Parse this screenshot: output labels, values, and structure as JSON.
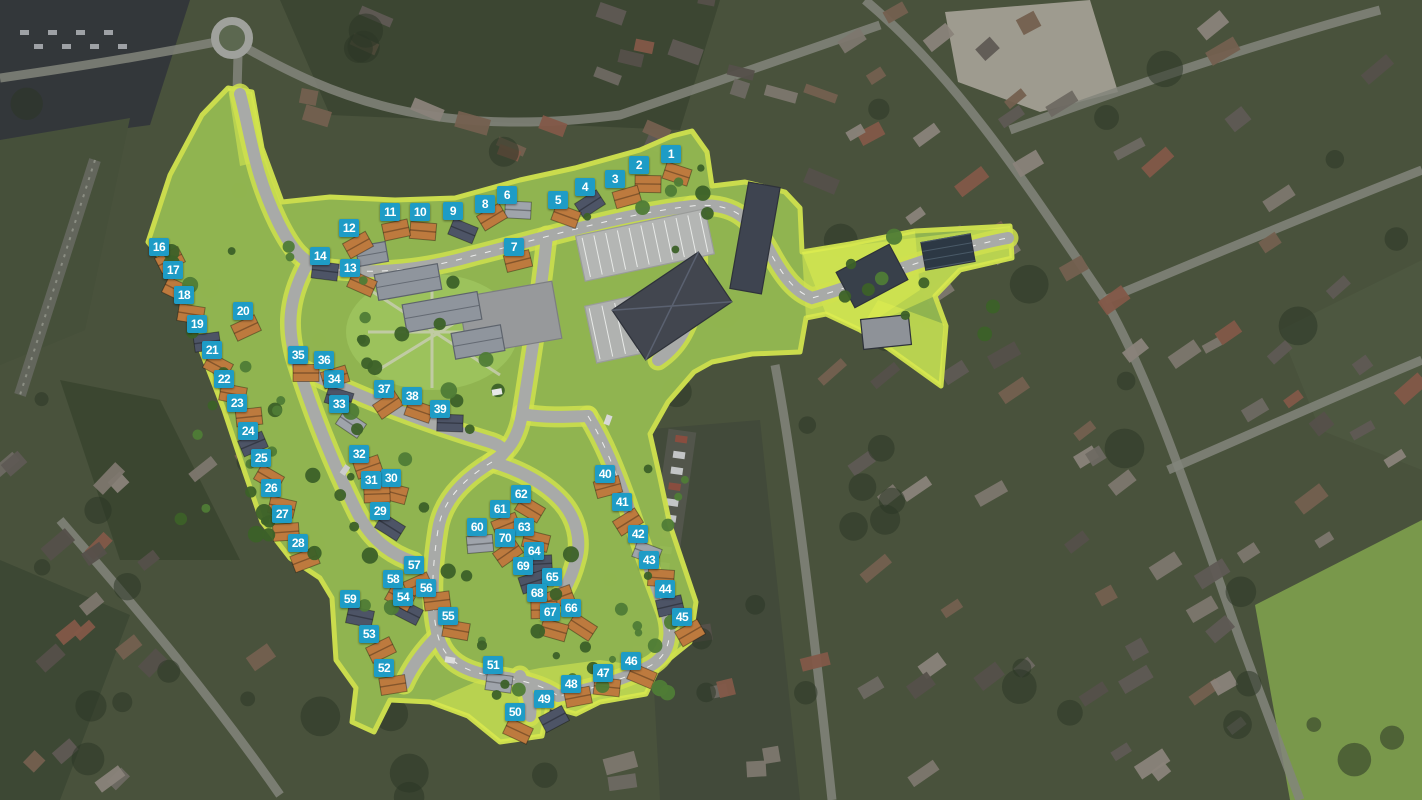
{
  "view": {
    "name": "housing-development-siteplan-aerial",
    "description": "Aerial masterplan with numbered plot markers",
    "width": 1422,
    "height": 800
  },
  "colors": {
    "marker_bg": "#1e9cc6",
    "marker_text": "#ffffff",
    "site_grass": "#93b851",
    "site_verge": "#cfe14e",
    "site_bright": "#dff04f",
    "road": "#a8aaa8",
    "road_centerline": "#ffffff",
    "roof_orange": "#bd7a3e",
    "roof_dark": "#4d5466",
    "roof_gray": "#9fa4ab",
    "building_dark": "#42464f",
    "plaza": "#97999b",
    "aerial_base": "#49523c"
  },
  "markers": [
    {
      "n": 1,
      "x": 671,
      "y": 154
    },
    {
      "n": 2,
      "x": 639,
      "y": 165
    },
    {
      "n": 3,
      "x": 615,
      "y": 179
    },
    {
      "n": 4,
      "x": 585,
      "y": 187
    },
    {
      "n": 5,
      "x": 558,
      "y": 200
    },
    {
      "n": 6,
      "x": 507,
      "y": 195
    },
    {
      "n": 7,
      "x": 514,
      "y": 247
    },
    {
      "n": 8,
      "x": 485,
      "y": 204
    },
    {
      "n": 9,
      "x": 453,
      "y": 211
    },
    {
      "n": 10,
      "x": 420,
      "y": 212
    },
    {
      "n": 11,
      "x": 390,
      "y": 212
    },
    {
      "n": 12,
      "x": 349,
      "y": 228
    },
    {
      "n": 13,
      "x": 350,
      "y": 268
    },
    {
      "n": 14,
      "x": 320,
      "y": 256
    },
    {
      "n": 16,
      "x": 159,
      "y": 247
    },
    {
      "n": 17,
      "x": 173,
      "y": 270
    },
    {
      "n": 18,
      "x": 184,
      "y": 295
    },
    {
      "n": 19,
      "x": 197,
      "y": 324
    },
    {
      "n": 20,
      "x": 243,
      "y": 311
    },
    {
      "n": 21,
      "x": 212,
      "y": 350
    },
    {
      "n": 22,
      "x": 224,
      "y": 379
    },
    {
      "n": 23,
      "x": 237,
      "y": 403
    },
    {
      "n": 24,
      "x": 248,
      "y": 431
    },
    {
      "n": 25,
      "x": 261,
      "y": 458
    },
    {
      "n": 26,
      "x": 271,
      "y": 488
    },
    {
      "n": 27,
      "x": 282,
      "y": 514
    },
    {
      "n": 28,
      "x": 298,
      "y": 543
    },
    {
      "n": 29,
      "x": 380,
      "y": 511
    },
    {
      "n": 30,
      "x": 391,
      "y": 478
    },
    {
      "n": 31,
      "x": 371,
      "y": 480
    },
    {
      "n": 32,
      "x": 359,
      "y": 454
    },
    {
      "n": 33,
      "x": 339,
      "y": 404
    },
    {
      "n": 34,
      "x": 334,
      "y": 379
    },
    {
      "n": 35,
      "x": 298,
      "y": 355
    },
    {
      "n": 36,
      "x": 324,
      "y": 360
    },
    {
      "n": 37,
      "x": 384,
      "y": 389
    },
    {
      "n": 38,
      "x": 412,
      "y": 396
    },
    {
      "n": 39,
      "x": 440,
      "y": 409
    },
    {
      "n": 40,
      "x": 605,
      "y": 474
    },
    {
      "n": 41,
      "x": 622,
      "y": 502
    },
    {
      "n": 42,
      "x": 638,
      "y": 534
    },
    {
      "n": 43,
      "x": 649,
      "y": 560
    },
    {
      "n": 44,
      "x": 665,
      "y": 589
    },
    {
      "n": 45,
      "x": 682,
      "y": 617
    },
    {
      "n": 46,
      "x": 631,
      "y": 661
    },
    {
      "n": 47,
      "x": 603,
      "y": 673
    },
    {
      "n": 48,
      "x": 571,
      "y": 684
    },
    {
      "n": 49,
      "x": 544,
      "y": 699
    },
    {
      "n": 50,
      "x": 515,
      "y": 712
    },
    {
      "n": 51,
      "x": 493,
      "y": 665
    },
    {
      "n": 52,
      "x": 384,
      "y": 668
    },
    {
      "n": 53,
      "x": 369,
      "y": 634
    },
    {
      "n": 54,
      "x": 403,
      "y": 597
    },
    {
      "n": 55,
      "x": 448,
      "y": 616
    },
    {
      "n": 56,
      "x": 426,
      "y": 588
    },
    {
      "n": 57,
      "x": 414,
      "y": 565
    },
    {
      "n": 58,
      "x": 393,
      "y": 579
    },
    {
      "n": 59,
      "x": 350,
      "y": 599
    },
    {
      "n": 60,
      "x": 477,
      "y": 527
    },
    {
      "n": 61,
      "x": 500,
      "y": 509
    },
    {
      "n": 62,
      "x": 521,
      "y": 494
    },
    {
      "n": 63,
      "x": 524,
      "y": 527
    },
    {
      "n": 64,
      "x": 534,
      "y": 551
    },
    {
      "n": 65,
      "x": 552,
      "y": 577
    },
    {
      "n": 66,
      "x": 571,
      "y": 608
    },
    {
      "n": 67,
      "x": 550,
      "y": 612
    },
    {
      "n": 68,
      "x": 537,
      "y": 593
    },
    {
      "n": 69,
      "x": 523,
      "y": 566
    },
    {
      "n": 70,
      "x": 505,
      "y": 538
    }
  ]
}
